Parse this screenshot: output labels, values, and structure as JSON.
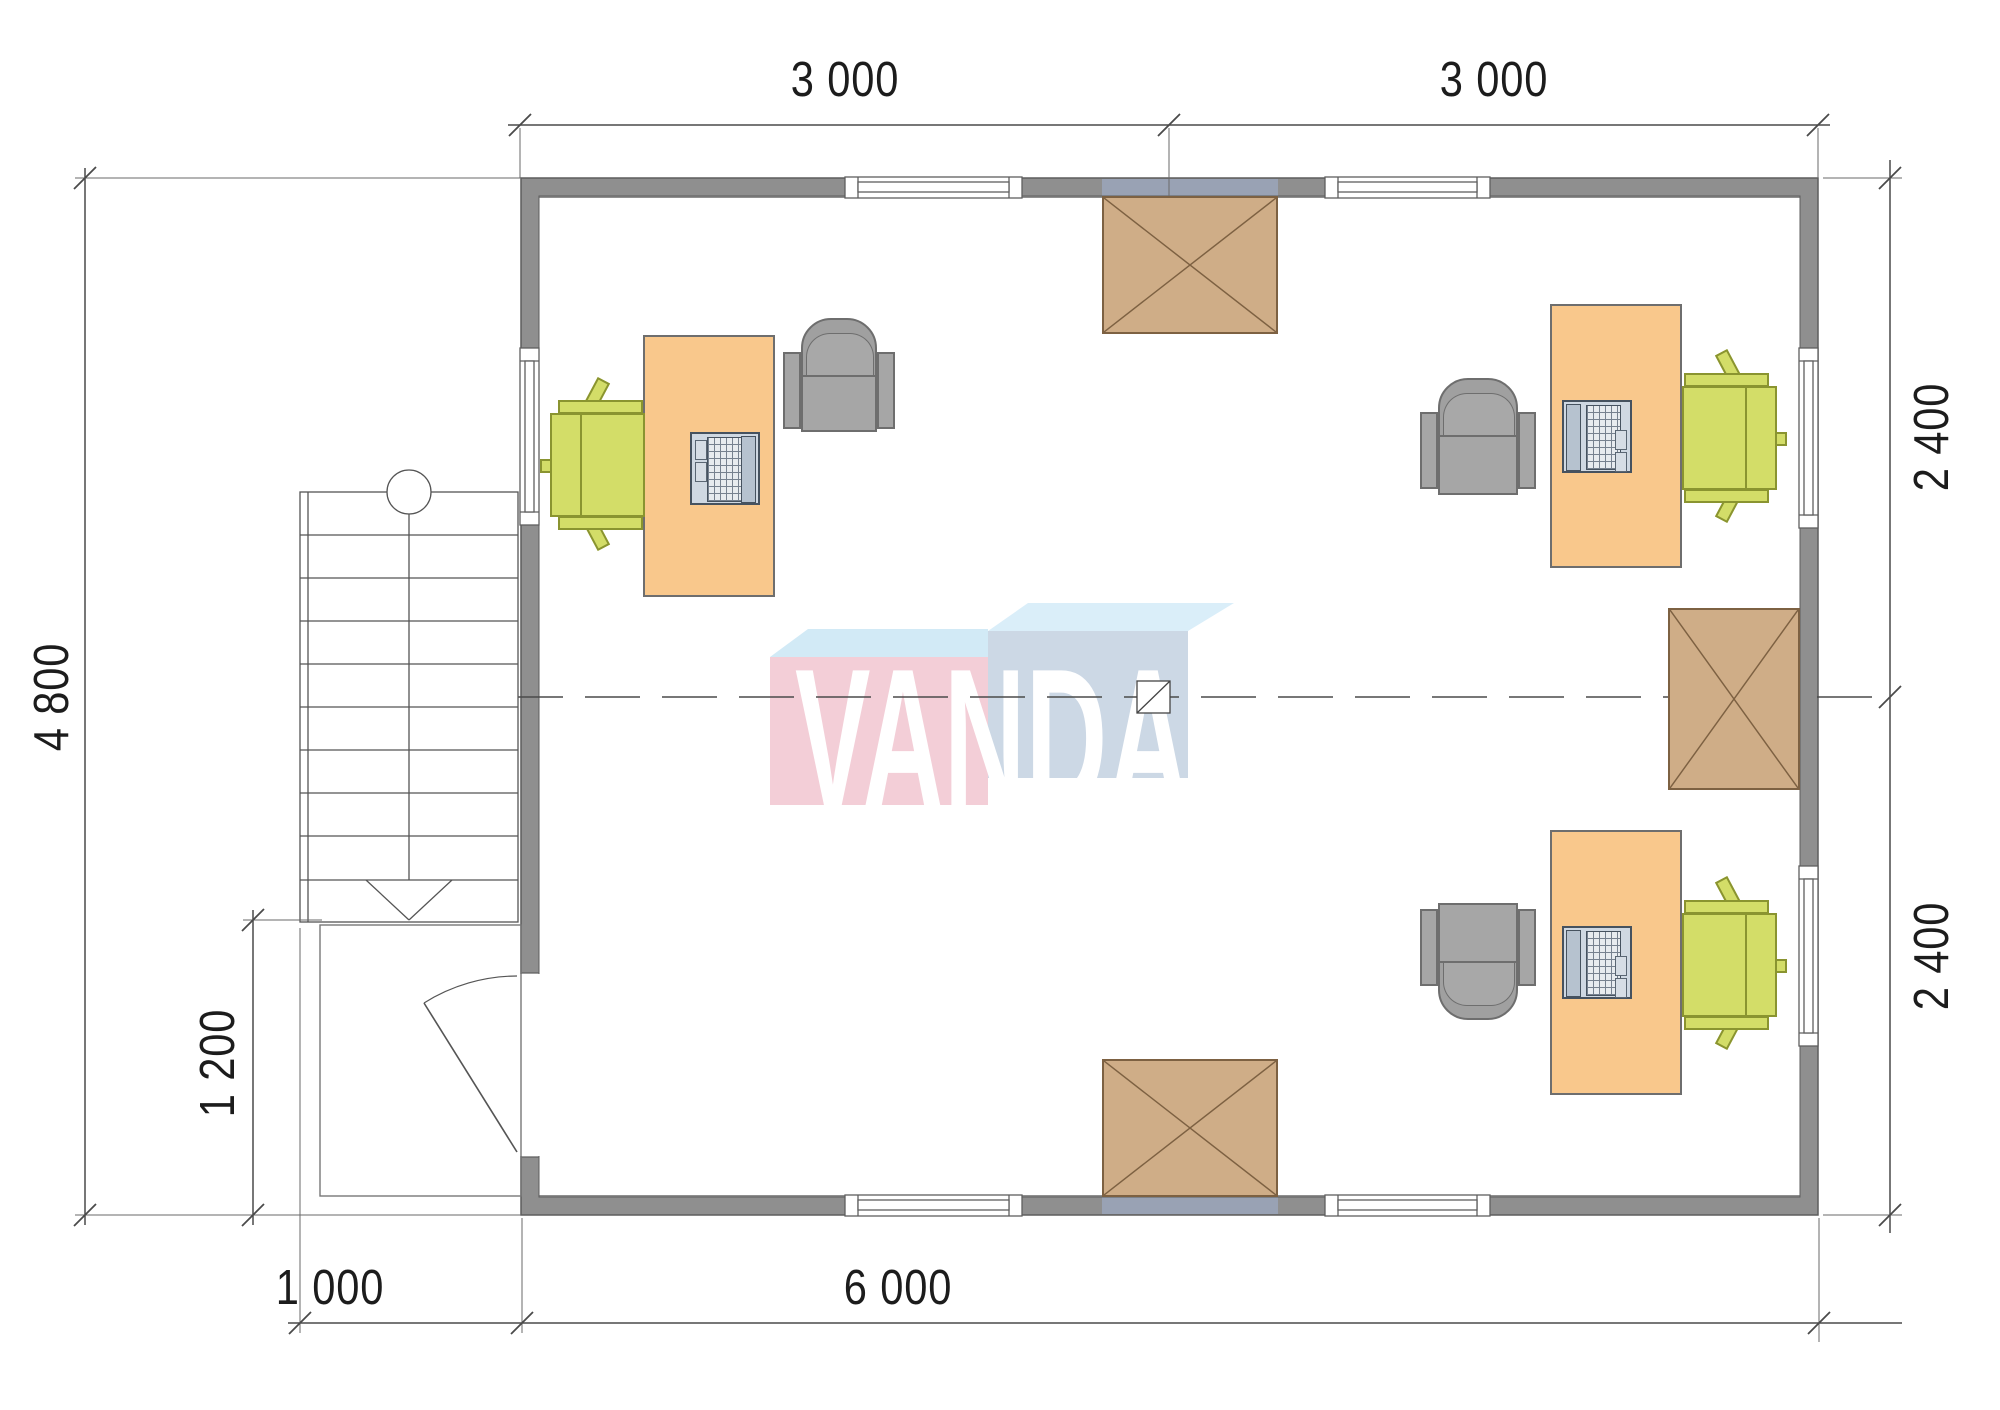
{
  "drawing": {
    "type": "office floor plan, top view",
    "watermark": "VANDA"
  },
  "dimensions": {
    "top_left_span": "3 000",
    "top_right_span": "3 000",
    "left_height": "4 800",
    "porch_height": "1 200",
    "porch_width": "1 000",
    "bottom_width": "6 000",
    "right_upper_span": "2 400",
    "right_lower_span": "2 400"
  },
  "colors": {
    "wall": "#8f8f8f",
    "wall_accent": "#99a2b4",
    "desk": "#f9c88c",
    "chair_green": "#d3dd68",
    "chair_gray": "#a6a6a6",
    "laptop": "#cfd8e2",
    "hatch_box": "#cfad87",
    "hatch_border": "#7d6142",
    "logo_pink": "#f3ced7",
    "logo_blue_gray": "#ccd8e5",
    "logo_cyan_top": "#d2eaf6",
    "logo_text": "#ffffff",
    "line": "#4a4a4a"
  }
}
